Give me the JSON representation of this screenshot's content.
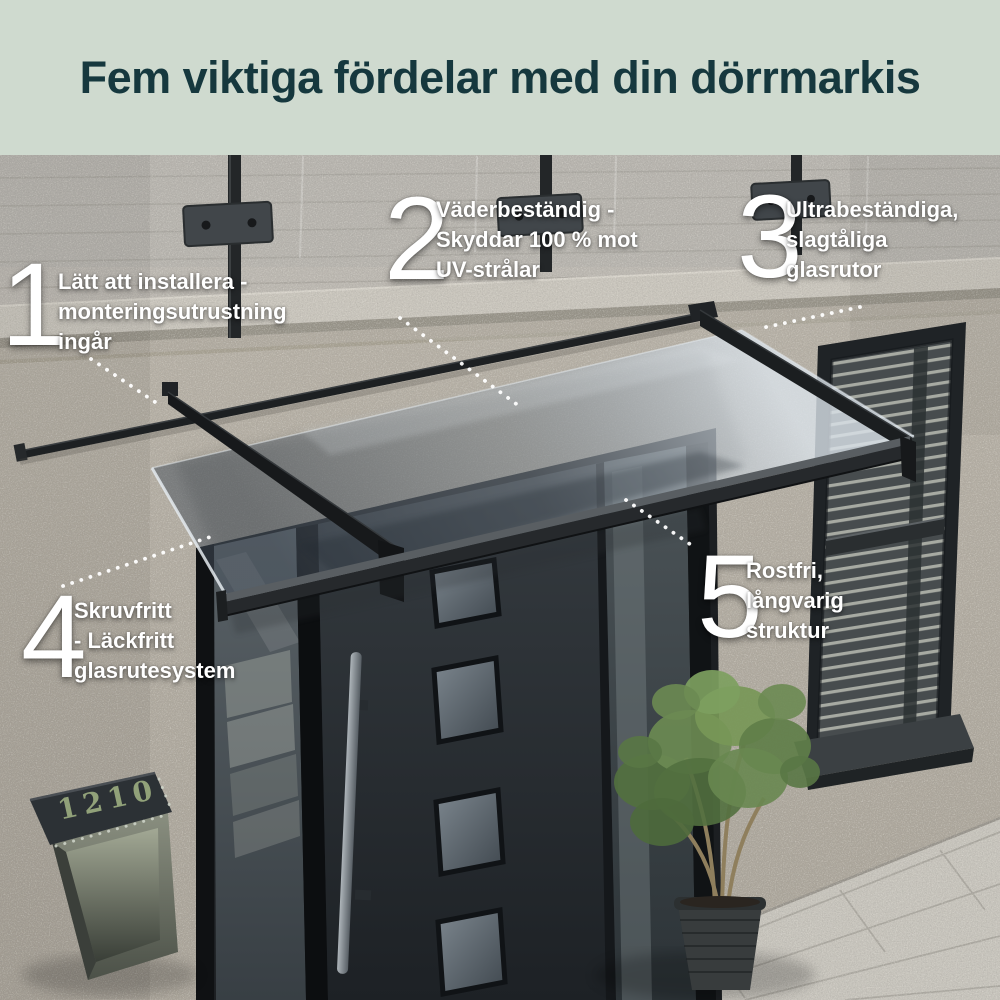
{
  "header": {
    "title": "Fem viktiga fördelar med din dörrmarkis"
  },
  "benefits": [
    {
      "number": "1",
      "lines": [
        "Lätt att installera -",
        "monteringsutrustning",
        "ingår"
      ]
    },
    {
      "number": "2",
      "lines": [
        "Väderbeständig -",
        "Skyddar 100 % mot",
        "UV-strålar"
      ]
    },
    {
      "number": "3",
      "lines": [
        "Ultrabeständiga,",
        "slagtåliga",
        "glasrutor"
      ]
    },
    {
      "number": "4",
      "lines": [
        "Skruvfritt",
        "- Läckfritt",
        "glasrutesystem"
      ]
    },
    {
      "number": "5",
      "lines": [
        "Rostfri,",
        "långvarig",
        "struktur"
      ]
    }
  ],
  "scene": {
    "mailbox_number": "1210"
  },
  "colors": {
    "header_bg": "#cfdacf",
    "header_text": "#16383e",
    "label_text": "#ffffff",
    "mailbox_digits": "#9aab7f"
  }
}
